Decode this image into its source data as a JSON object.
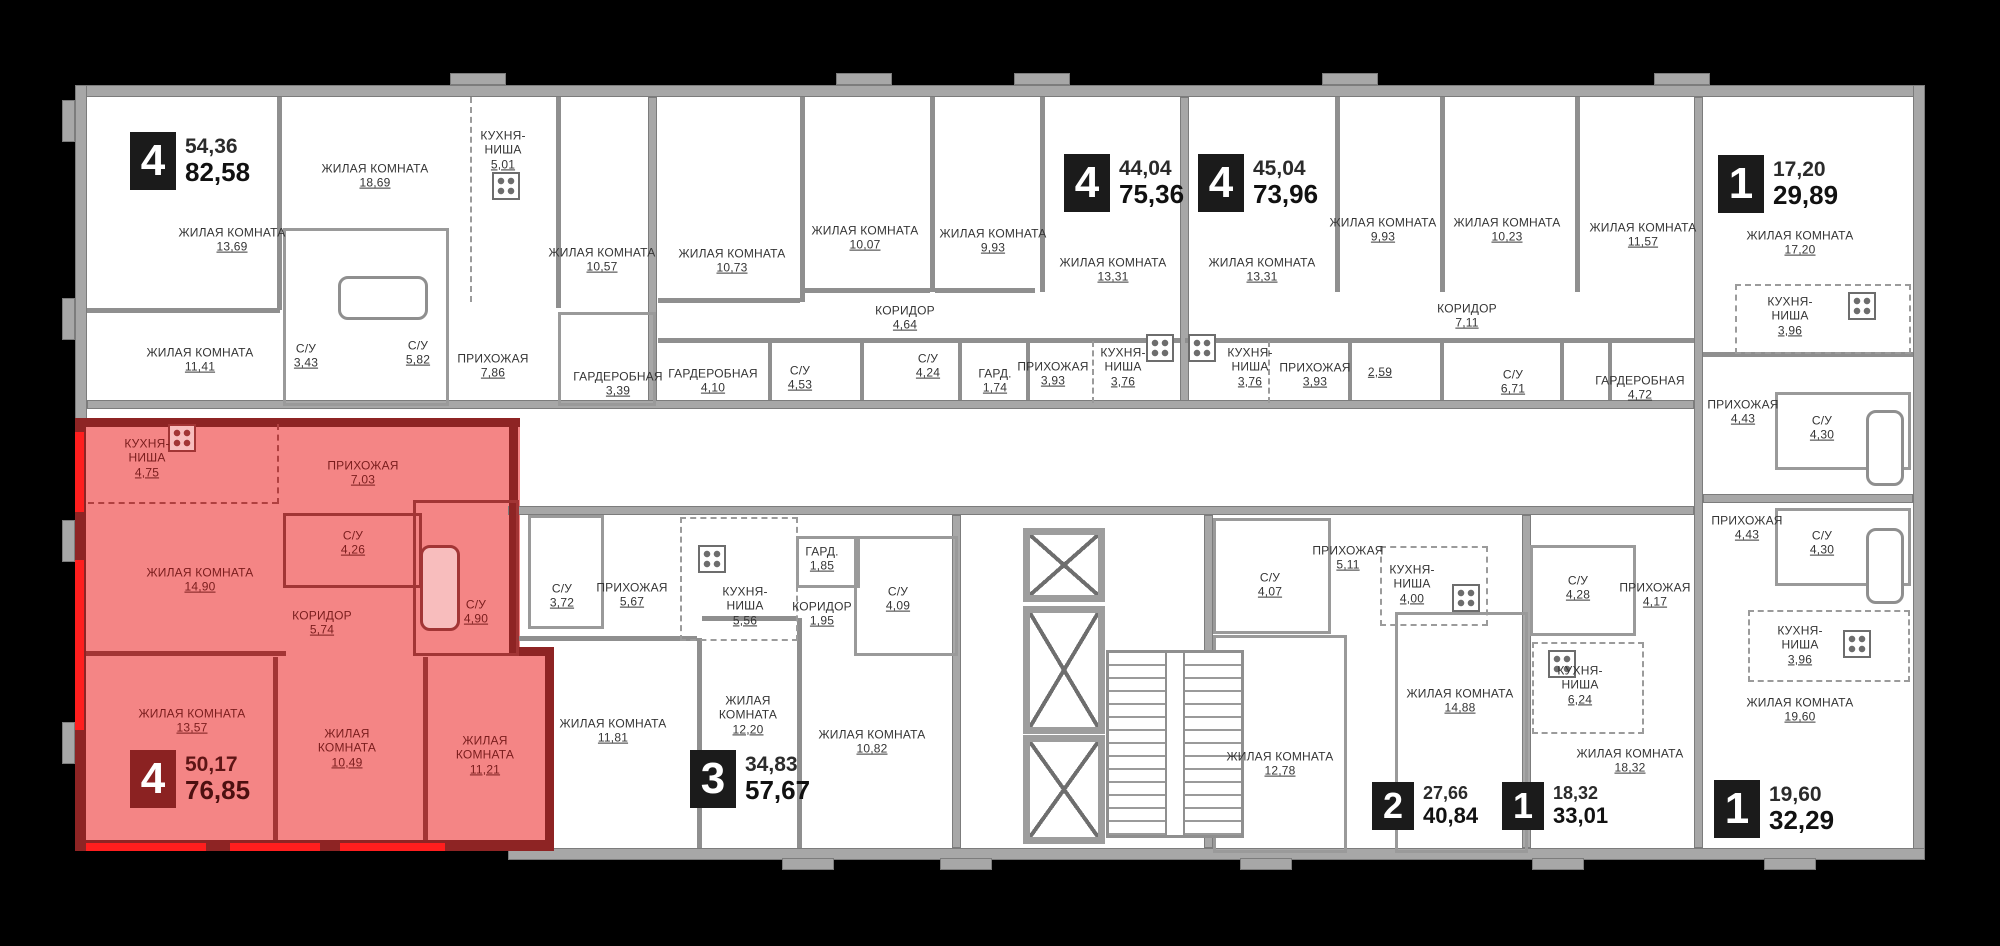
{
  "floorplan": {
    "colors": {
      "background": "#000000",
      "paper": "#ffffff",
      "wall": "#a7a7a7",
      "highlight_fill": "#f48585",
      "highlight_wall": "#8e2424",
      "highlight_accent": "#ff1e1e",
      "badge_bg": "#1b1b1b",
      "badge_selected_bg": "#8b2222"
    },
    "core": {
      "elevators": 3,
      "stairs": true
    },
    "apartments": [
      {
        "id": "A",
        "badge": "4",
        "area_living": "54,36",
        "area_total": "82,58",
        "highlighted": false,
        "rooms": [
          {
            "label": "ЖИЛАЯ КОМНАТА",
            "area": "13,69"
          },
          {
            "label": "ЖИЛАЯ КОМНАТА",
            "area": "18,69"
          },
          {
            "label": "КУХНЯ-НИША",
            "area": "5,01"
          },
          {
            "label": "ЖИЛАЯ КОМНАТА",
            "area": "10,57"
          },
          {
            "label": "ЖИЛАЯ КОМНАТА",
            "area": "11,41"
          },
          {
            "label": "С/У",
            "area": "3,43"
          },
          {
            "label": "С/У",
            "area": "5,82"
          },
          {
            "label": "ПРИХОЖАЯ",
            "area": "7,86"
          },
          {
            "label": "ГАРДЕРОБНАЯ",
            "area": "3,39"
          }
        ]
      },
      {
        "id": "B",
        "badge": "4",
        "area_living": "44,04",
        "area_total": "75,36",
        "highlighted": false,
        "rooms": [
          {
            "label": "ЖИЛАЯ КОМНАТА",
            "area": "10,73"
          },
          {
            "label": "ГАРДЕРОБНАЯ",
            "area": "4,10"
          },
          {
            "label": "С/У",
            "area": "4,53"
          },
          {
            "label": "КОРИДОР",
            "area": "4,64"
          },
          {
            "label": "ЖИЛАЯ КОМНАТА",
            "area": "10,07"
          },
          {
            "label": "С/У",
            "area": "4,24"
          },
          {
            "label": "ГАРД.",
            "area": "1,74"
          },
          {
            "label": "ЖИЛАЯ КОМНАТА",
            "area": "9,93"
          },
          {
            "label": "ПРИХОЖАЯ",
            "area": "3,93"
          },
          {
            "label": "КУХНЯ-НИША",
            "area": "3,76"
          },
          {
            "label": "ЖИЛАЯ КОМНАТА",
            "area": "13,31"
          }
        ]
      },
      {
        "id": "C",
        "badge": "4",
        "area_living": "45,04",
        "area_total": "73,96",
        "highlighted": false,
        "rooms": [
          {
            "label": "ЖИЛАЯ КОМНАТА",
            "area": "13,31"
          },
          {
            "label": "КУХНЯ-НИША",
            "area": "3,76"
          },
          {
            "label": "ПРИХОЖАЯ",
            "area": "3,93"
          },
          {
            "label": "",
            "area": "2,59"
          },
          {
            "label": "ЖИЛАЯ КОМНАТА",
            "area": "9,93"
          },
          {
            "label": "КОРИДОР",
            "area": "7,11"
          },
          {
            "label": "ЖИЛАЯ КОМНАТА",
            "area": "10,23"
          },
          {
            "label": "С/У",
            "area": "6,71"
          },
          {
            "label": "ЖИЛАЯ КОМНАТА",
            "area": "11,57"
          },
          {
            "label": "ГАРДЕРОБНАЯ",
            "area": "4,72"
          }
        ]
      },
      {
        "id": "D",
        "badge": "1",
        "area_living": "17,20",
        "area_total": "29,89",
        "highlighted": false,
        "rooms": [
          {
            "label": "ЖИЛАЯ КОМНАТА",
            "area": "17,20"
          },
          {
            "label": "КУХНЯ-НИША",
            "area": "3,96"
          },
          {
            "label": "ПРИХОЖАЯ",
            "area": "4,43"
          },
          {
            "label": "С/У",
            "area": "4,30"
          }
        ]
      },
      {
        "id": "E",
        "badge": "1",
        "area_living": "19,60",
        "area_total": "32,29",
        "highlighted": false,
        "rooms": [
          {
            "label": "ПРИХОЖАЯ",
            "area": "4,43"
          },
          {
            "label": "С/У",
            "area": "4,30"
          },
          {
            "label": "КУХНЯ-НИША",
            "area": "3,96"
          },
          {
            "label": "ЖИЛАЯ КОМНАТА",
            "area": "19,60"
          }
        ]
      },
      {
        "id": "F",
        "badge": "1",
        "area_living": "18,32",
        "area_total": "33,01",
        "highlighted": false,
        "rooms": [
          {
            "label": "С/У",
            "area": "4,28"
          },
          {
            "label": "КУХНЯ-НИША",
            "area": "6,24"
          },
          {
            "label": "ПРИХОЖАЯ",
            "area": "4,17"
          },
          {
            "label": "ЖИЛАЯ КОМНАТА",
            "area": "18,32"
          }
        ]
      },
      {
        "id": "G",
        "badge": "2",
        "area_living": "27,66",
        "area_total": "40,84",
        "highlighted": false,
        "rooms": [
          {
            "label": "С/У",
            "area": "4,07"
          },
          {
            "label": "ПРИХОЖАЯ",
            "area": "5,11"
          },
          {
            "label": "КУХНЯ-НИША",
            "area": "4,00"
          },
          {
            "label": "ЖИЛАЯ КОМНАТА",
            "area": "12,78"
          },
          {
            "label": "ЖИЛАЯ КОМНАТА",
            "area": "14,88"
          }
        ]
      },
      {
        "id": "H",
        "badge": "3",
        "area_living": "34,83",
        "area_total": "57,67",
        "highlighted": false,
        "rooms": [
          {
            "label": "С/У",
            "area": "3,72"
          },
          {
            "label": "ПРИХОЖАЯ",
            "area": "5,67"
          },
          {
            "label": "КУХНЯ-НИША",
            "area": "5,56"
          },
          {
            "label": "ГАРД.",
            "area": "1,85"
          },
          {
            "label": "КОРИДОР",
            "area": "1,95"
          },
          {
            "label": "С/У",
            "area": "4,09"
          },
          {
            "label": "ЖИЛАЯ КОМНАТА",
            "area": "11,81"
          },
          {
            "label": "ЖИЛАЯ КОМНАТА",
            "area": "12,20"
          },
          {
            "label": "ЖИЛАЯ КОМНАТА",
            "area": "10,82"
          }
        ]
      },
      {
        "id": "R",
        "badge": "4",
        "area_living": "50,17",
        "area_total": "76,85",
        "highlighted": true,
        "rooms": [
          {
            "label": "КУХНЯ-НИША",
            "area": "4,75"
          },
          {
            "label": "ПРИХОЖАЯ",
            "area": "7,03"
          },
          {
            "label": "С/У",
            "area": "4,26"
          },
          {
            "label": "ЖИЛАЯ КОМНАТА",
            "area": "14,90"
          },
          {
            "label": "КОРИДОР",
            "area": "5,74"
          },
          {
            "label": "С/У",
            "area": "4,90"
          },
          {
            "label": "ЖИЛАЯ КОМНАТА",
            "area": "13,57"
          },
          {
            "label": "ЖИЛАЯ КОМНАТА",
            "area": "10,49"
          },
          {
            "label": "ЖИЛАЯ КОМНАТА",
            "area": "11,21"
          }
        ]
      }
    ]
  }
}
